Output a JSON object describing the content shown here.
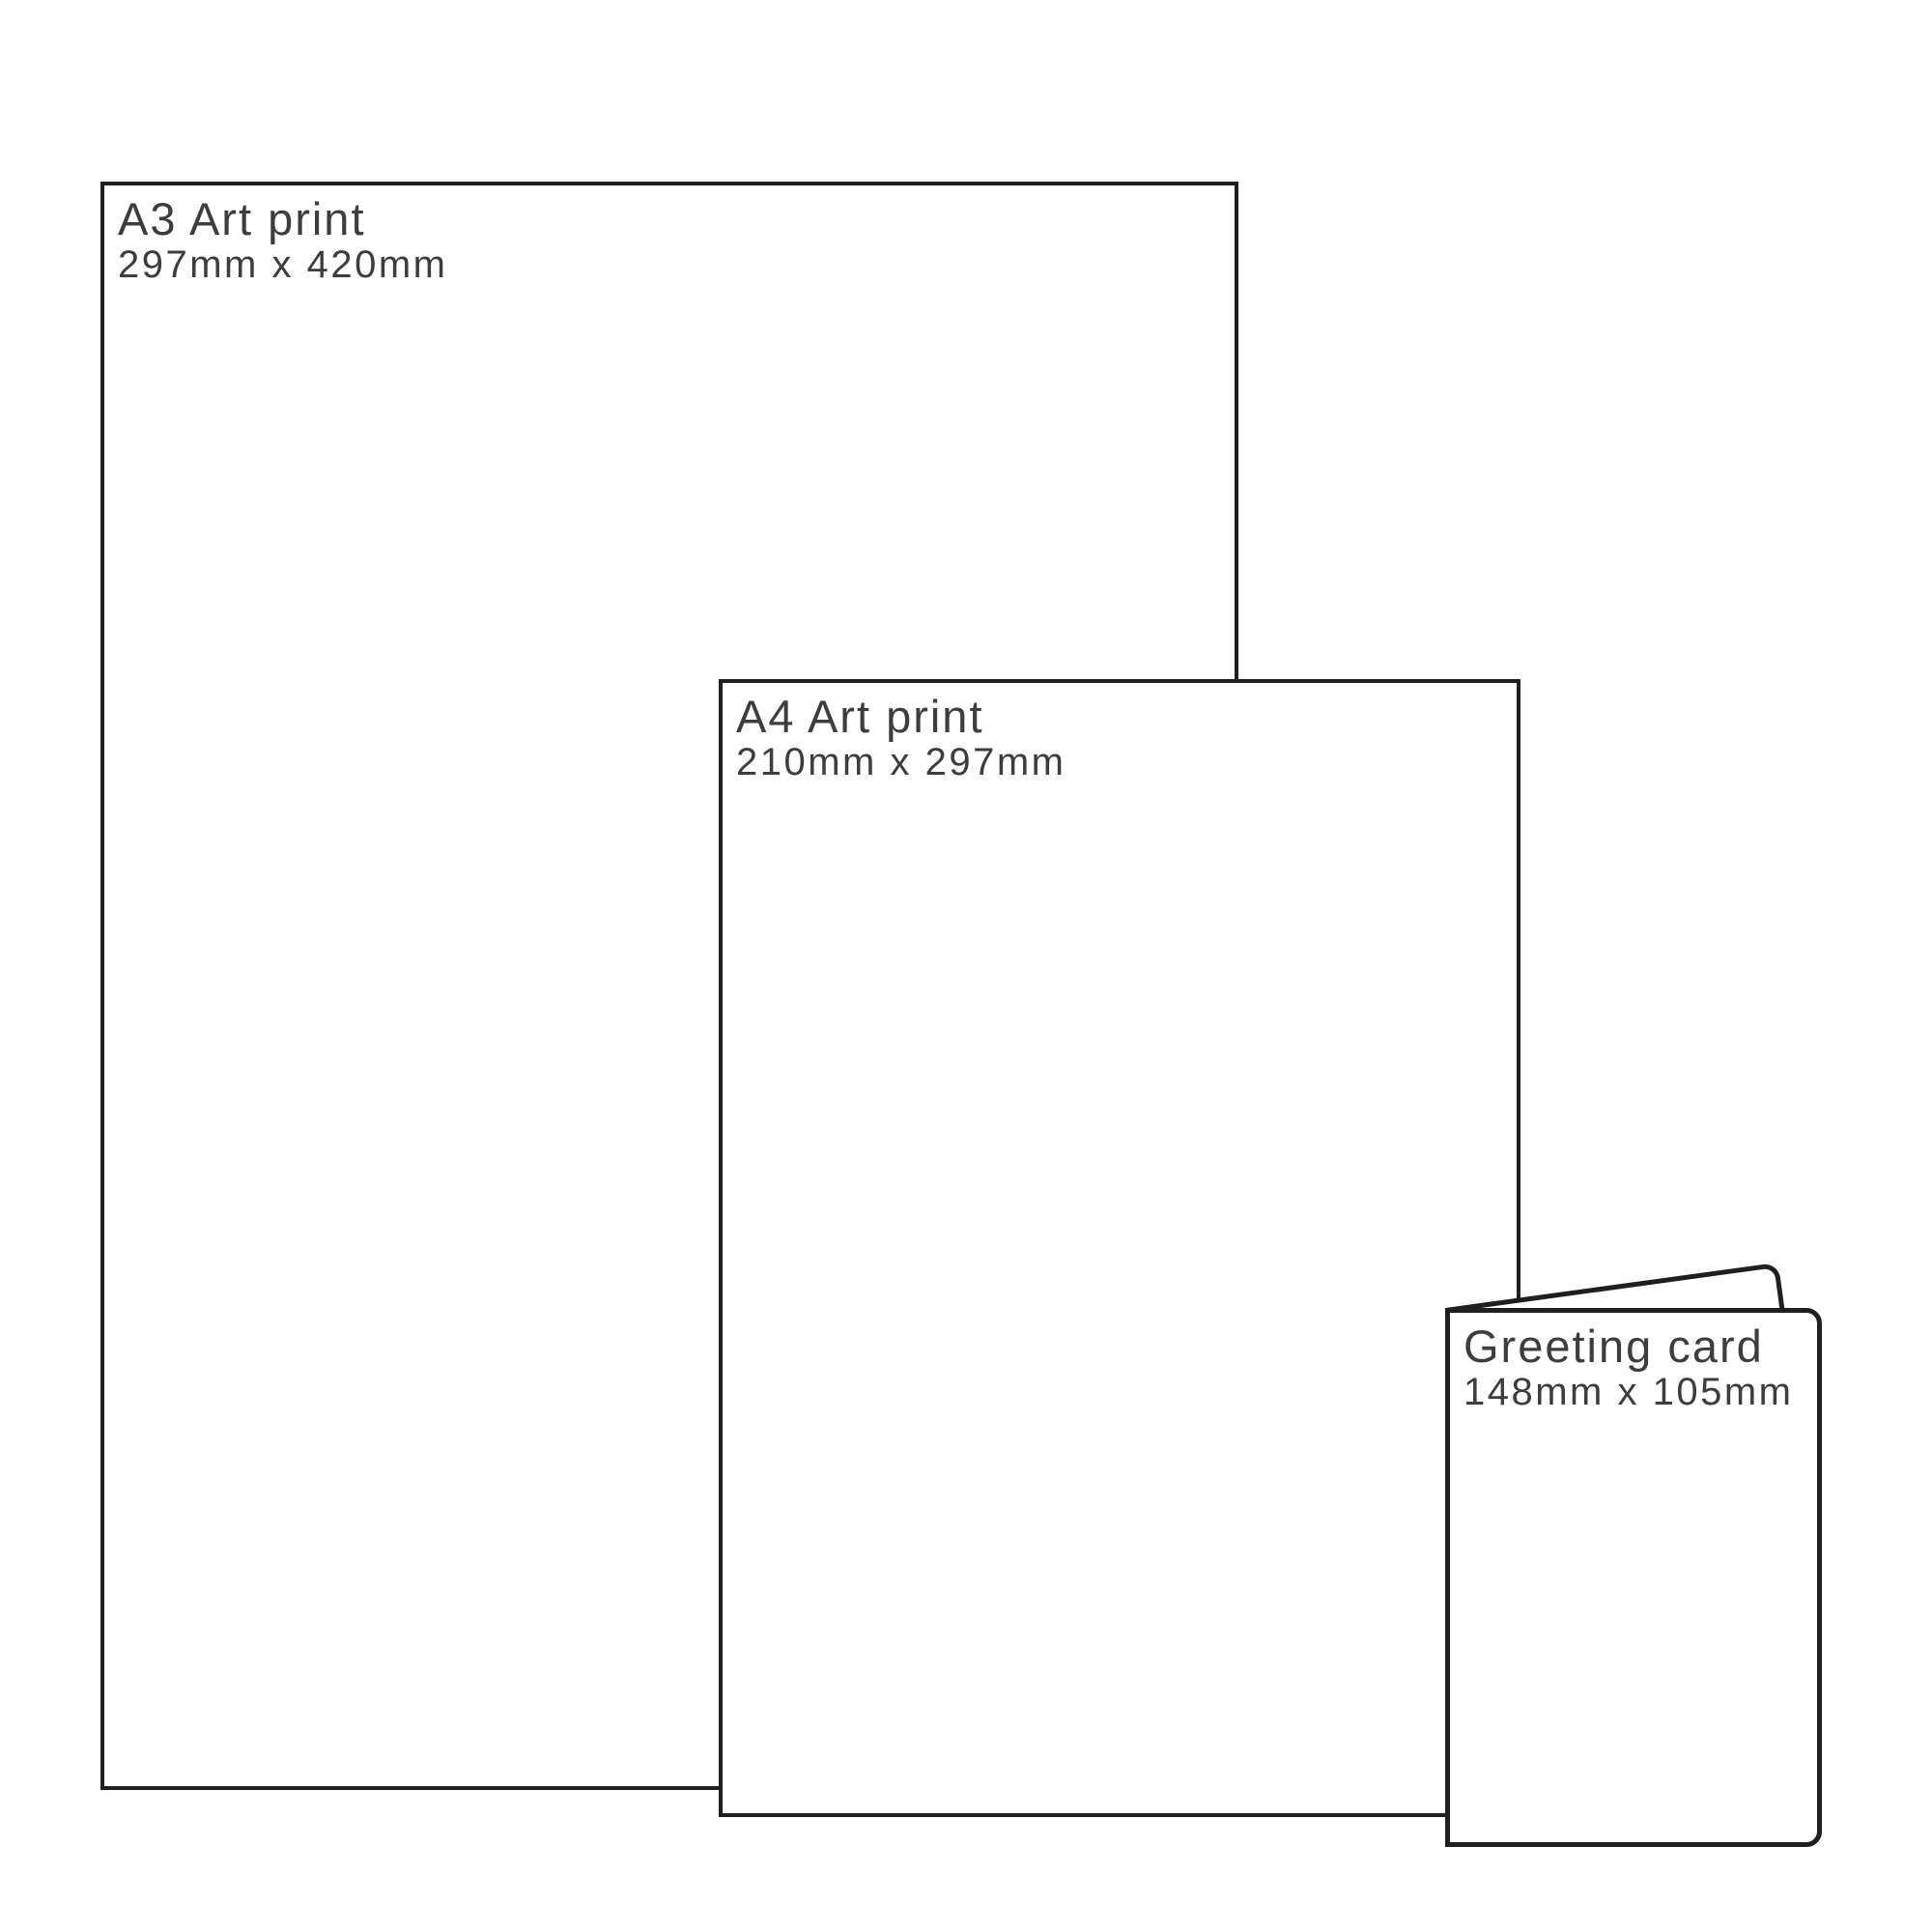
{
  "canvas": {
    "background": "#ffffff",
    "line_color": "#1f1f1f",
    "text_color": "#3d3d3d"
  },
  "items": [
    {
      "id": "a3-art-print",
      "title": "A3 Art print",
      "dimensions": "297mm x 420mm"
    },
    {
      "id": "a4-art-print",
      "title": "A4 Art print",
      "dimensions": "210mm x 297mm"
    },
    {
      "id": "greeting-card",
      "title": "Greeting card",
      "dimensions": "148mm x 105mm"
    }
  ]
}
